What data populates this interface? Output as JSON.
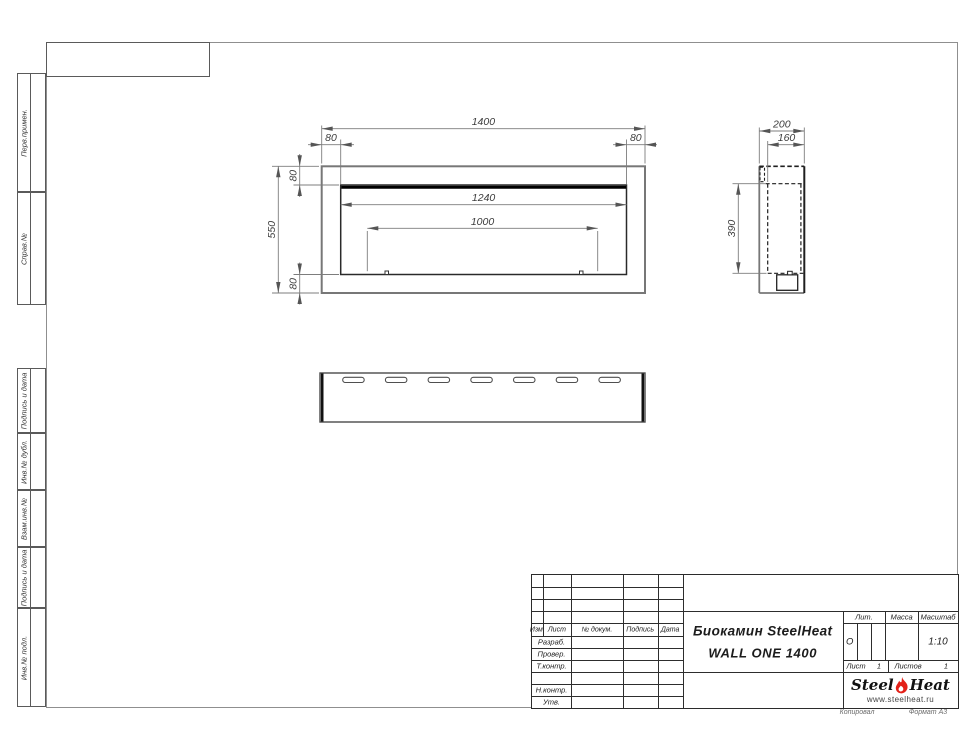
{
  "sidebar": {
    "cells": [
      {
        "label": "Перв.примен."
      },
      {
        "label": "Справ.№"
      },
      {
        "label": "Подпись и дата"
      },
      {
        "label": "Инв.№ дубл."
      },
      {
        "label": "Взам.инв.№"
      },
      {
        "label": "Подпись и дата"
      },
      {
        "label": "Инв.№ подл."
      }
    ]
  },
  "views": {
    "front": {
      "total_width": "1400",
      "frame_left": "80",
      "frame_right": "80",
      "frame_top": "80",
      "frame_bottom": "80",
      "total_height": "550",
      "opening_width": "1240",
      "burner_width": "1000"
    },
    "side": {
      "depth": "200",
      "inner_depth": "160",
      "opening_height": "390"
    }
  },
  "title_block": {
    "rev_headers": [
      "Изм.",
      "Лист",
      "№ докум.",
      "Подпись",
      "Дата"
    ],
    "roles": [
      "Разраб.",
      "Провер.",
      "Т.контр.",
      "Н.контр.",
      "Утв."
    ],
    "product": "Биокамин SteelHeat",
    "model": "WALL ONE 1400",
    "lit_header": "Лит.",
    "mass_header": "Масса",
    "scale_header": "Масштаб",
    "lit_value": "О",
    "scale_value": "1:10",
    "sheet_label": "Лист",
    "sheet_value": "1",
    "sheets_label": "Листов",
    "sheets_value": "1",
    "logo": {
      "part1": "Steel",
      "part2": "Heat",
      "site": "www.steelheat.ru"
    },
    "footer_left": "Копировал",
    "footer_right": "Формат А3"
  }
}
